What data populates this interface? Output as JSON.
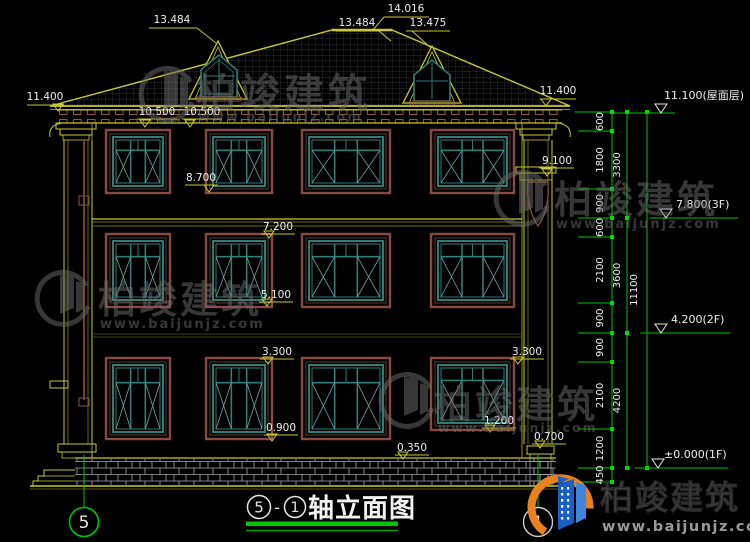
{
  "watermark": {
    "brand": "柏竣建筑",
    "url": "www.baijunjz.com"
  },
  "logo": {
    "brand": "柏竣建筑",
    "url": "www.baijunjz.com"
  },
  "title_bar": {
    "axis_from": "5",
    "separator": "-",
    "axis_to": "1",
    "name": "轴立面图"
  },
  "grid_bubble_left": "5",
  "grid_bubble_right": "1",
  "elevation_flags": [
    "13.484",
    "14.016",
    "13.484",
    "13.475",
    "11.400",
    "11.400",
    "10.500",
    "10.500",
    "9.100",
    "8.700",
    "7.200",
    "5.100",
    "3.300",
    "3.300",
    "0.900",
    "1.200",
    "0.350",
    "0.700"
  ],
  "right_dimensions": {
    "segments": [
      "600",
      "1800",
      "900",
      "600",
      "2100",
      "900",
      "900",
      "2100",
      "1200",
      "450"
    ],
    "floor_heights": [
      "3300",
      "3600",
      "4200"
    ],
    "total": "11100",
    "levels": [
      "11.100(屋面层)",
      "7.800(3F)",
      "4.200(2F)",
      "±0.000(1F)"
    ]
  },
  "colors": {
    "cad_yellow": "#c8c832",
    "cad_green": "#00c400",
    "window_teal": "#2f7d74",
    "frame_brown": "#8a4a42",
    "logo_blue": "#1b5fc4",
    "logo_orange": "#e8821e"
  }
}
